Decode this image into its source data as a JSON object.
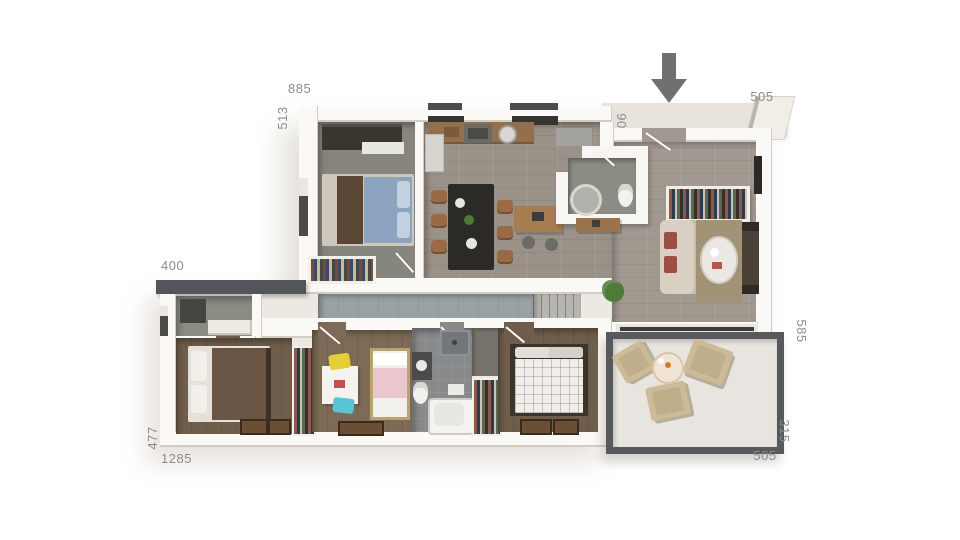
{
  "dimensions": {
    "top_width": "885",
    "upper_left_height": "513",
    "entry_width": "505",
    "entry_depth": "90",
    "annex_width": "400",
    "right_height": "585",
    "lower_left_height": "477",
    "total_width": "1285",
    "terrace_height": "315",
    "terrace_width": "505"
  },
  "entrance": {
    "arrow_direction": "down"
  },
  "colors": {
    "canvas-bg": "#ffffff",
    "dim-label": "#8c8c8c",
    "arrow": "#6f7072",
    "wall": "#fbf9f6",
    "wall-top": "#ece8e2",
    "wood-floor": "#9a9188",
    "living-floor": "#a19890",
    "bedroom1-floor": "#87867e",
    "dark-wood-floor": "#6f5e4c",
    "kids-floor": "#7d6b57",
    "bath-floor": "#87898b",
    "corridor-floor": "#99a0a6",
    "terrace-floor": "#e8e5e1",
    "terrace-border": "#58595a",
    "roof-bar": "#54555a",
    "island": "#2b2a27",
    "chair-wood": "#9b6a45",
    "sofa": "#d9d0c3",
    "rug": "#a29377",
    "accent-yellow": "#e5cf39",
    "accent-teal": "#58c4d4",
    "accent-pink": "#eac6cd",
    "accent-blue": "#8da4c0",
    "plant-green": "#4e7a3a"
  }
}
